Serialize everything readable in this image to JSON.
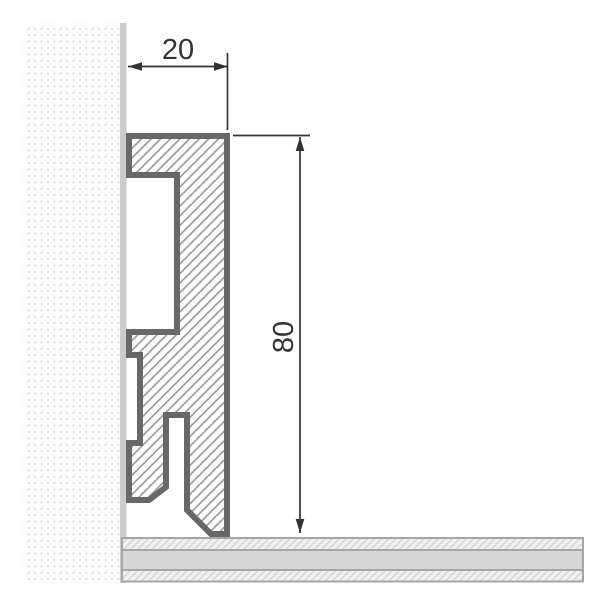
{
  "drawing": {
    "title": "skirting-board-profile-cross-section",
    "type": "technical-dimension-drawing",
    "dimensions": {
      "width_label": "20",
      "height_label": "80"
    },
    "components": {
      "wall": "wall-section-dotted",
      "wall_strip": "wall-surface-strip",
      "floor": "layered-floor-section",
      "profile": "hatched-skirting-profile"
    },
    "colors": {
      "outline_color": "#686868",
      "hatch_line_color": "#8f8f8f",
      "wall_strip_color": "#cccccc",
      "wall_dot_color": "#d9d9d9",
      "floor_solid_color": "#d6d6d6",
      "floor_border_color": "#a6a6a6",
      "floor_hatch_bg_color": "#f1f1f1",
      "floor_hatch_line_color": "#d4d4d4",
      "dimension_color": "#333333",
      "background_color": "#ffffff"
    }
  }
}
